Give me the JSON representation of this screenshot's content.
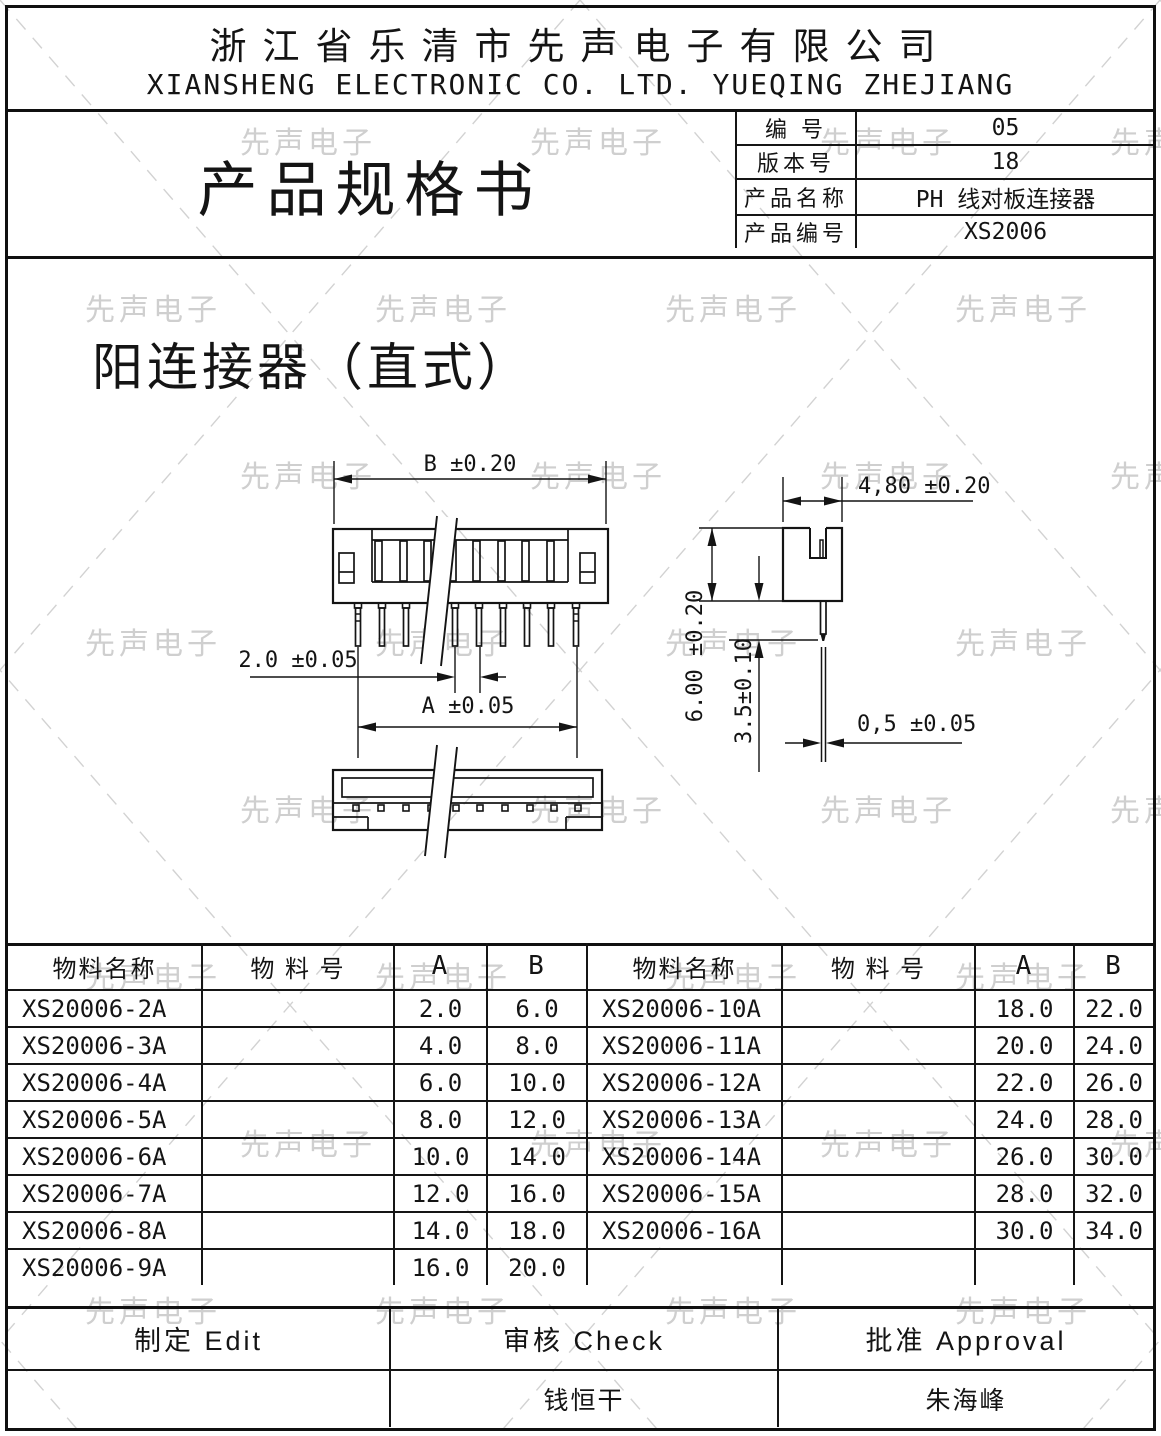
{
  "company": {
    "name_cn": "浙江省乐清市先声电子有限公司",
    "name_en": "XIANSHENG ELECTRONIC CO. LTD. YUEQING ZHEJIANG"
  },
  "doc": {
    "title": "产品规格书",
    "info": [
      {
        "label": "编  号",
        "value": "05"
      },
      {
        "label": "版本号",
        "value": "18"
      },
      {
        "label": "产品名称",
        "value": "PH  线对板连接器"
      },
      {
        "label": "产品编号",
        "value": "XS2006"
      }
    ]
  },
  "watermark": {
    "text": "先声电子"
  },
  "drawing": {
    "section_title": "阳连接器（直式）",
    "dims": {
      "b": "B ±0.20",
      "pitch": "2.0 ±0.05",
      "a": "A ±0.05",
      "sv_width": "4,80 ±0.20",
      "sv_height": "6.00 ±0.20",
      "sv_pin_len": "3.5±0.10",
      "sv_pin_w": "0,5 ±0.05"
    }
  },
  "parts_table": {
    "headers": [
      "物料名称",
      "物 料 号",
      "A",
      "B"
    ],
    "left": [
      {
        "name": "XS20006-2A",
        "pn": "",
        "a": "2.0",
        "b": "6.0"
      },
      {
        "name": "XS20006-3A",
        "pn": "",
        "a": "4.0",
        "b": "8.0"
      },
      {
        "name": "XS20006-4A",
        "pn": "",
        "a": "6.0",
        "b": "10.0"
      },
      {
        "name": "XS20006-5A",
        "pn": "",
        "a": "8.0",
        "b": "12.0"
      },
      {
        "name": "XS20006-6A",
        "pn": "",
        "a": "10.0",
        "b": "14.0"
      },
      {
        "name": "XS20006-7A",
        "pn": "",
        "a": "12.0",
        "b": "16.0"
      },
      {
        "name": "XS20006-8A",
        "pn": "",
        "a": "14.0",
        "b": "18.0"
      },
      {
        "name": "XS20006-9A",
        "pn": "",
        "a": "16.0",
        "b": "20.0"
      }
    ],
    "right": [
      {
        "name": "XS20006-10A",
        "pn": "",
        "a": "18.0",
        "b": "22.0"
      },
      {
        "name": "XS20006-11A",
        "pn": "",
        "a": "20.0",
        "b": "24.0"
      },
      {
        "name": "XS20006-12A",
        "pn": "",
        "a": "22.0",
        "b": "26.0"
      },
      {
        "name": "XS20006-13A",
        "pn": "",
        "a": "24.0",
        "b": "28.0"
      },
      {
        "name": "XS20006-14A",
        "pn": "",
        "a": "26.0",
        "b": "30.0"
      },
      {
        "name": "XS20006-15A",
        "pn": "",
        "a": "28.0",
        "b": "32.0"
      },
      {
        "name": "XS20006-16A",
        "pn": "",
        "a": "30.0",
        "b": "34.0"
      },
      {
        "name": "",
        "pn": "",
        "a": "",
        "b": ""
      }
    ]
  },
  "footer": {
    "edit_label": "制定  Edit",
    "check_label": "审核  Check",
    "approval_label": "批准  Approval",
    "edit_name": "",
    "check_name": "钱恒干",
    "approval_name": "朱海峰"
  }
}
